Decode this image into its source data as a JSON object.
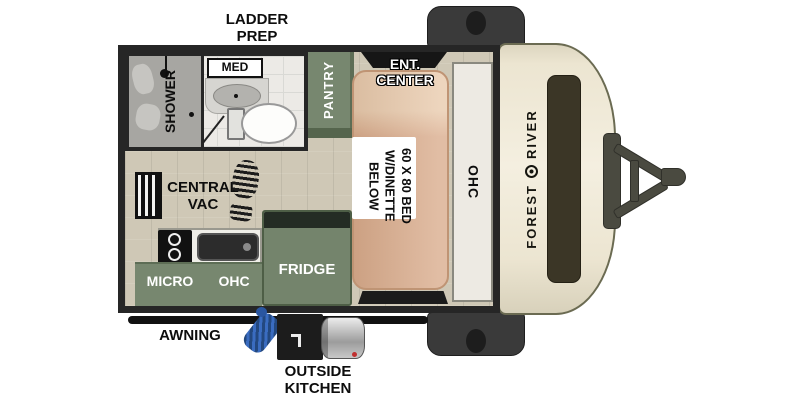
{
  "labels": {
    "ladder_prep": "LADDER\nPREP",
    "shower": "SHOWER",
    "med": "MED",
    "pantry": "PANTRY",
    "ent_center": "ENT.\nCENTER",
    "bed": "60 X 80 BED\nW/DINETTE\nBELOW",
    "ohc_right": "OHC",
    "central_vac": "CENTRAL\nVAC",
    "micro": "MICRO",
    "ohc_kitchen": "OHC",
    "fridge": "FRIDGE",
    "awning": "AWNING",
    "outside_kitchen": "OUTSIDE\nKITCHEN"
  },
  "brand": {
    "first": "FOREST",
    "second": "RIVER"
  },
  "colors": {
    "wall": "#262626",
    "floor": "#cfc8b6",
    "cabinet_green": "#77876f",
    "cabinet_green_dark": "#55654d",
    "fridge_green": "#74846c",
    "bed_tan": "#d9ab8b",
    "bed_pillow": "#e8c9ab",
    "ohc_light": "#edeae3",
    "cap_cream": "#ece5d1",
    "cap_window": "#3b3626",
    "hitch_gray": "#4a4a40",
    "fender_gray": "#3a3a3a",
    "awning_black": "#111111",
    "hose_blue": "#3a6cc0",
    "bath_floor": "#eceae6",
    "shower_gray": "#a7a6a2"
  }
}
